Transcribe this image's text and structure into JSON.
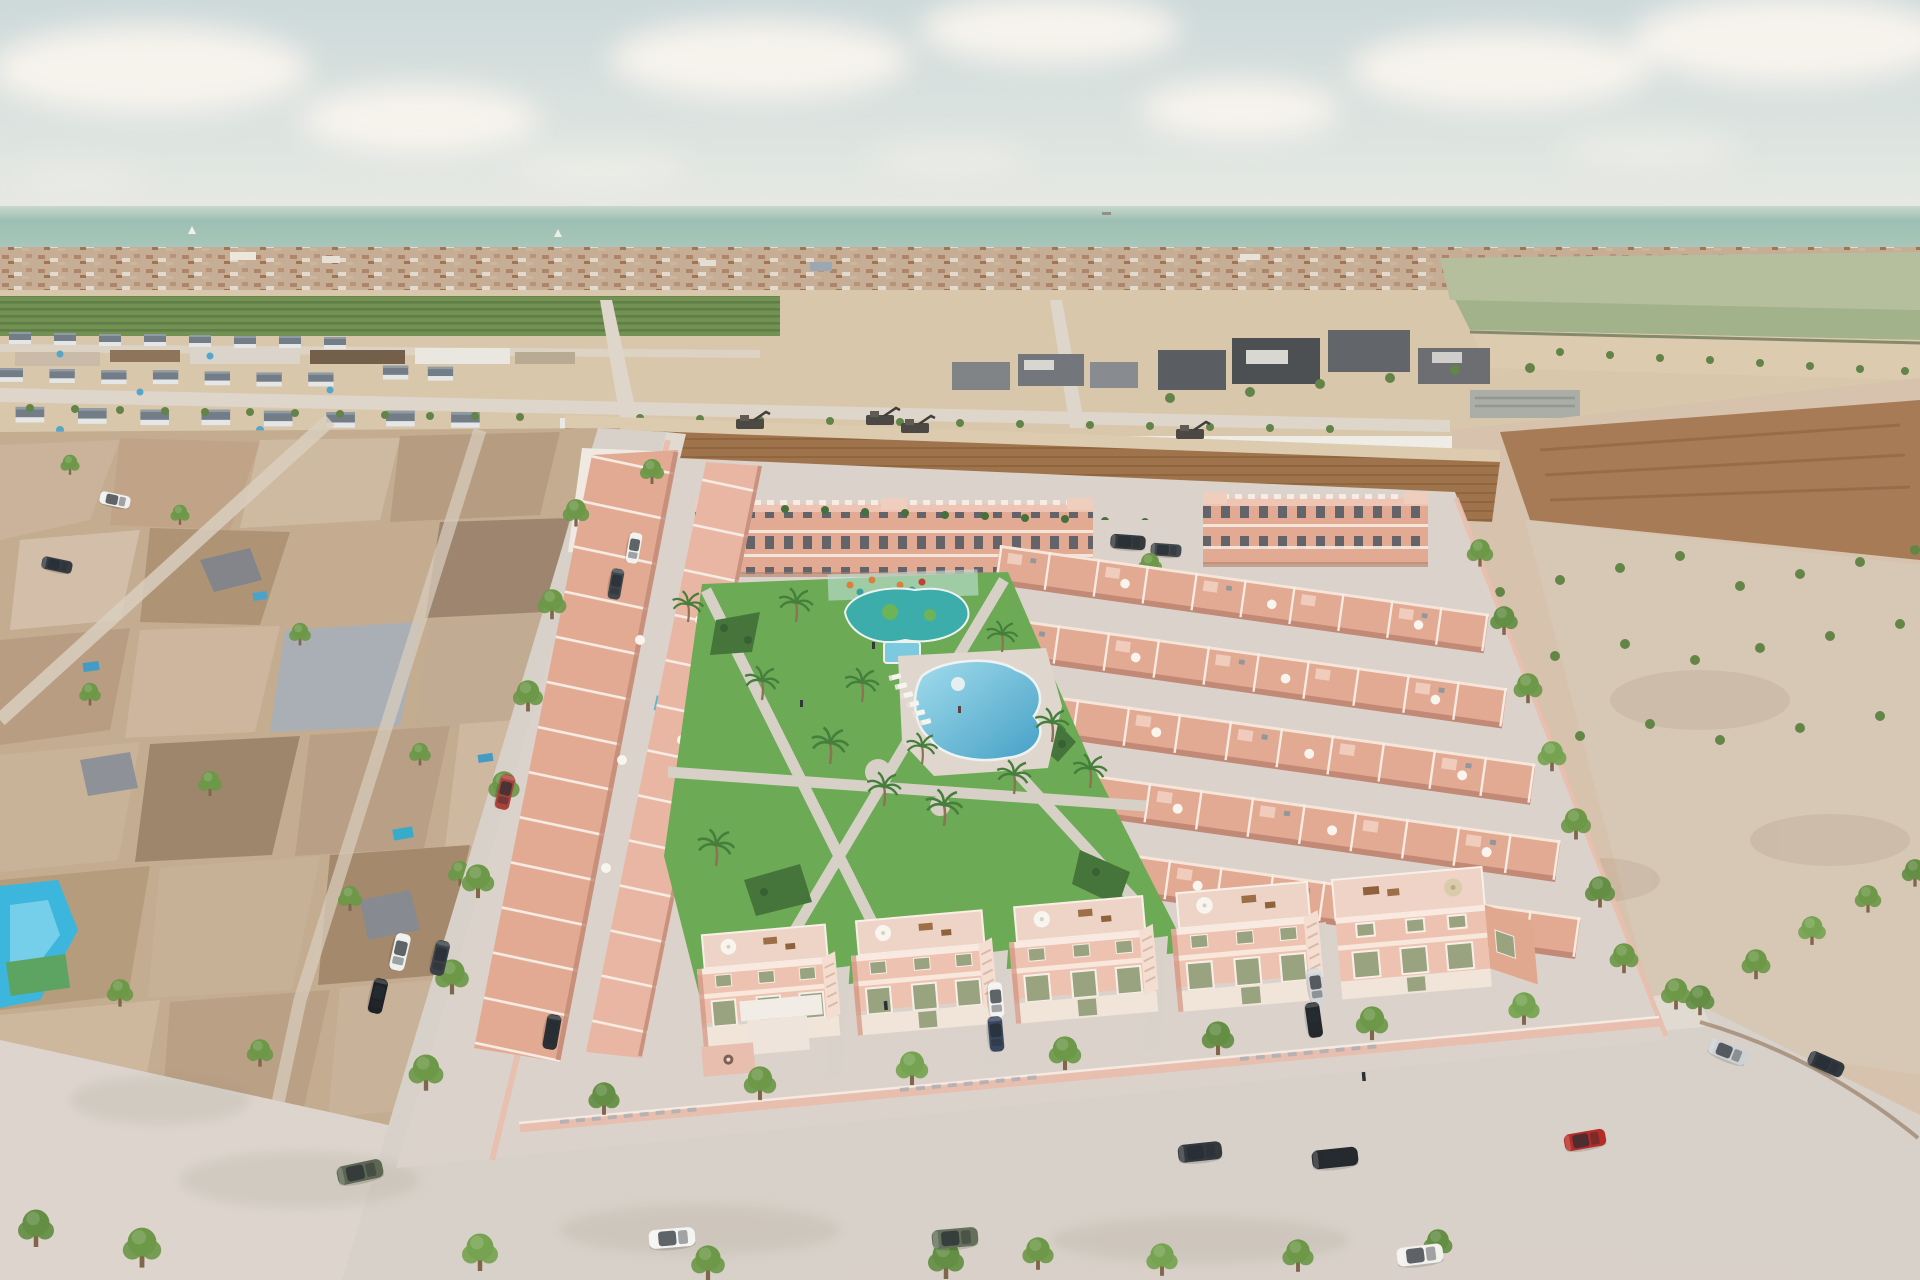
{
  "scene": {
    "type": "aerial-3d-architectural-render",
    "subject": "New-build coastal residential development of salmon-pink townhouses and apartment blocks with communal pools and landscaped gardens, viewed from the air; existing low-poly neighbourhood to the west, vacant land east, ploughed field north, distant coastal town and sea on the horizon",
    "time_of_day": "hazy day",
    "sea": {
      "sailboats": 2,
      "ships": 1
    },
    "development": {
      "apartment_blocks": 2,
      "townhouse_rows_right": 5,
      "townhouse_rows_left": 2,
      "street_facing_villas": 5,
      "communal_pools": [
        "kids-lagoon-pool",
        "plunge-pool",
        "main-lagoon-pool"
      ],
      "rooftop_plunge_pools": 3,
      "sun_loungers": 6,
      "palm_trees": 13,
      "construction_machines": 4
    },
    "surroundings": [
      "existing low-poly neighbourhood west",
      "grey townhouse estate north-west",
      "orchard strip",
      "warehouse row",
      "ploughed field north",
      "vacant land east",
      "dark industrial buildings north-east",
      "distant coastal town",
      "sea horizon"
    ],
    "street": {
      "street_trees": 30,
      "cars_total": 24
    }
  },
  "palette": {
    "skyTop": "#ccd8d9",
    "skyBottom": "#efece5",
    "cloud": "#f6f3ec",
    "sea": "#9abdb1",
    "seaHaze": "#c7d6cb",
    "town": "#c3aa92",
    "townDark": "#a87d5f",
    "townLight": "#e9e1d4",
    "orchard": "#6d8d4d",
    "orchardDark": "#597a3f",
    "farmPale": "#b2bd9a",
    "fieldTan": "#d8c5a9",
    "sand": "#dcc9ad",
    "dirt": "#9c6e44",
    "dirtDark": "#885c34",
    "meshTan": "#c2a98d",
    "meshGrey": "#a9adb4",
    "greyWall": "#e3e5e6",
    "greyRoof": "#6e7883",
    "darkBld": "#55585c",
    "lawn": "#68a750",
    "bed": "#3f7034",
    "path": "#d6cfc5",
    "poolMain": "#3e9dc5",
    "poolLight": "#9fdbeb",
    "poolTeal": "#35aaa8",
    "plunge": "#77c8df",
    "salmon": "#e2a78f",
    "salmonLight": "#eec0ae",
    "salmonDark": "#c9886f",
    "parapet": "#f7ece2",
    "sageWin": "#95a07b",
    "wallPink": "#e8bcab",
    "roadGrey": "#d7d0c7",
    "sidewalk": "#e0d9d0",
    "pavement": "#dad2c9",
    "curbBrown": "#6e4f38",
    "treeGreen": "#679441",
    "trunk": "#7b6044"
  },
  "cars": [
    {
      "name": "parked-white-suv",
      "hex": "#f4f4f2"
    },
    {
      "name": "parked-green-suv",
      "hex": "#5f6b54"
    },
    {
      "name": "parked-dark-suv",
      "hex": "#2c3136"
    },
    {
      "name": "parked-black-suv",
      "hex": "#1e2226"
    },
    {
      "name": "parked-red-hatchback",
      "hex": "#b3241f"
    },
    {
      "name": "moving-white-sedan",
      "hex": "#f2f1ee"
    },
    {
      "name": "moving-green-suv",
      "hex": "#57624c"
    },
    {
      "name": "silver-sedan-east",
      "hex": "#ccd0d3"
    },
    {
      "name": "dark-sedan-east",
      "hex": "#2b3037"
    },
    {
      "name": "parked-red-car-west",
      "hex": "#a83a32"
    },
    {
      "name": "parked-white-pickup-west",
      "hex": "#eef0ee"
    },
    {
      "name": "parked-dark-car-west",
      "hex": "#343a40"
    },
    {
      "name": "parked-black-car-west",
      "hex": "#15191d"
    },
    {
      "name": "white-car-northwest",
      "hex": "#f1f2f0"
    },
    {
      "name": "dark-car-northwest",
      "hex": "#3a4046"
    },
    {
      "name": "white-car-mesh-street",
      "hex": "#f0f1ef"
    },
    {
      "name": "dark-car-mesh-street",
      "hex": "#2f353b"
    },
    {
      "name": "driveway-white-car",
      "hex": "#f2f2f0"
    },
    {
      "name": "driveway-blue-car",
      "hex": "#31415a"
    },
    {
      "name": "driveway-silver-car",
      "hex": "#d2d5d8"
    },
    {
      "name": "driveway-black-car",
      "hex": "#1c2024"
    },
    {
      "name": "courtyard-dark-car",
      "hex": "#24282c"
    },
    {
      "name": "van-dark-1",
      "hex": "#2e3338"
    },
    {
      "name": "van-dark-2",
      "hex": "#3c4248"
    }
  ]
}
